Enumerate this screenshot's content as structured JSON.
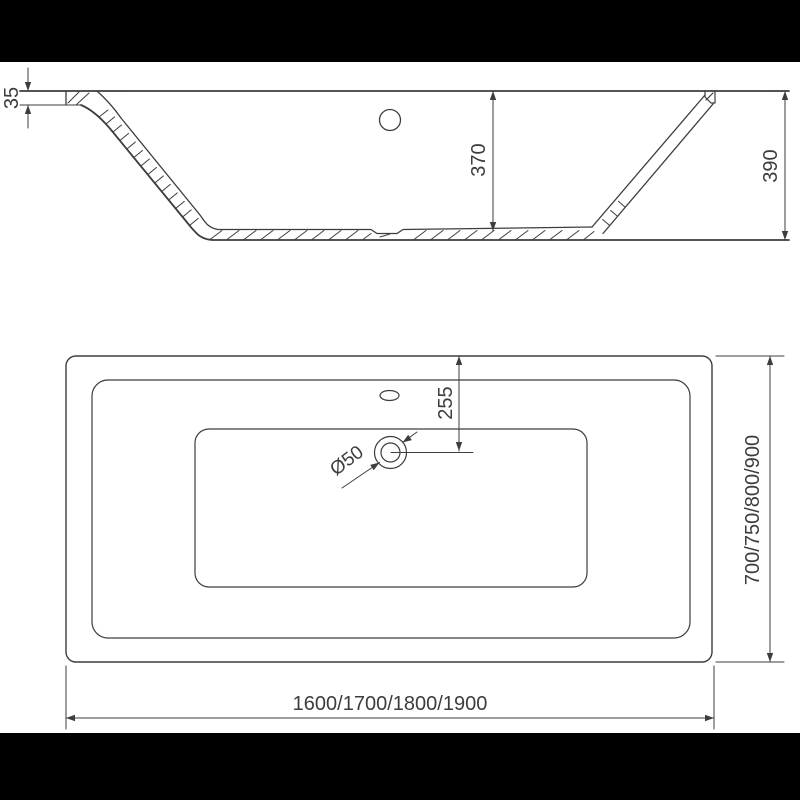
{
  "colors": {
    "background": "#ffffff",
    "letterbox": "#000000",
    "line": "#3d3d3d"
  },
  "side_view": {
    "dim_rim_height": "35",
    "dim_inner_depth": "370",
    "dim_overall_height": "390"
  },
  "plan_view": {
    "dim_drain_offset": "255",
    "dim_drain_diameter": "Ø50",
    "dim_width_options": "700/750/800/900",
    "dim_length_options": "1600/1700/1800/1900"
  }
}
